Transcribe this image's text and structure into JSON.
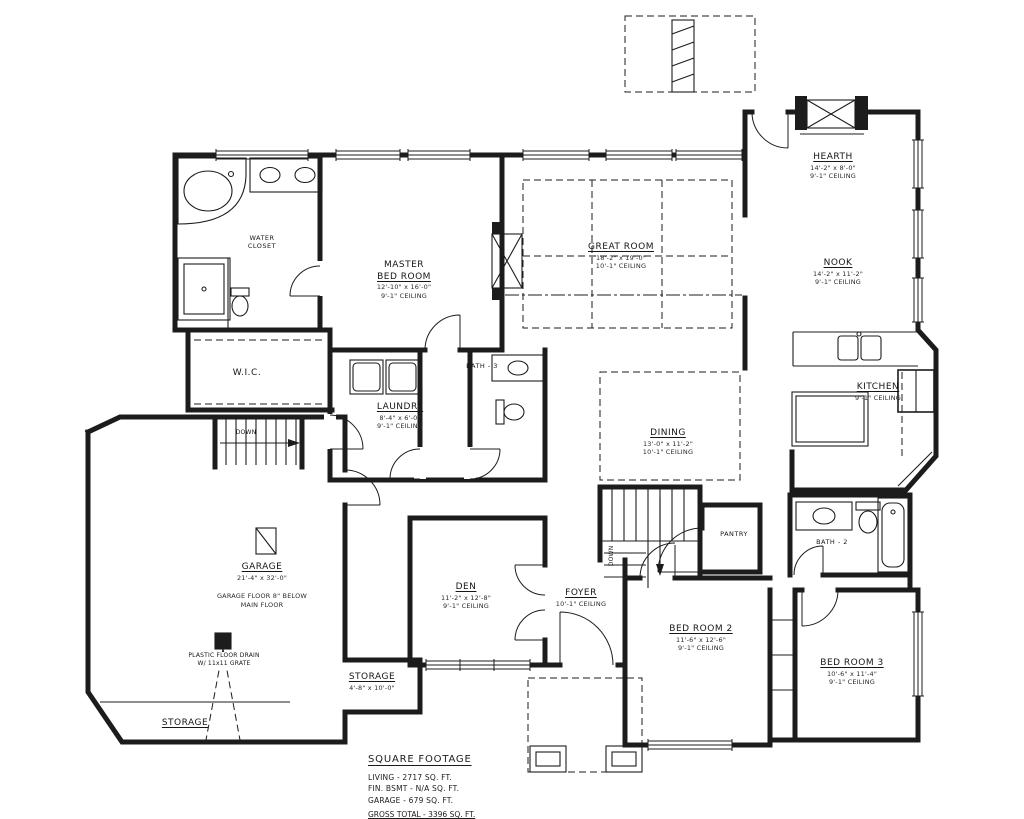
{
  "colors": {
    "line": "#1c1c1c",
    "background": "#ffffff"
  },
  "rooms": {
    "master": {
      "name_top": "MASTER",
      "name": "BED ROOM",
      "dims": "12'-10\" x 16'-0\"",
      "ceiling": "9'-1\" CEILING"
    },
    "great": {
      "name": "GREAT ROOM",
      "dims": "18'-2\" x 19'-0\"",
      "ceiling": "10'-1\" CEILING"
    },
    "hearth": {
      "name": "HEARTH",
      "dims": "14'-2\" x 8'-0\"",
      "ceiling": "9'-1\" CEILING"
    },
    "nook": {
      "name": "NOOK",
      "dims": "14'-2\" x 11'-2\"",
      "ceiling": "9'-1\" CEILING"
    },
    "kitchen": {
      "name": "KITCHEN",
      "ceiling": "9'-1\" CEILING"
    },
    "dining": {
      "name": "DINING",
      "dims": "13'-0\" x 11'-2\"",
      "ceiling": "10'-1\" CEILING"
    },
    "laundry": {
      "name": "LAUNDRY",
      "dims": "8'-4\" x 6'-0\"",
      "ceiling": "9'-1\" CEILING"
    },
    "wic": {
      "name": "W.I.C."
    },
    "garage": {
      "name": "GARAGE",
      "dims": "21'-4\" x 32'-0\"",
      "note1": "GARAGE FLOOR 8\" BELOW",
      "note2": "MAIN FLOOR"
    },
    "den": {
      "name": "DEN",
      "dims": "11'-2\" x 12'-8\"",
      "ceiling": "9'-1\" CEILING"
    },
    "foyer": {
      "name": "FOYER",
      "ceiling": "10'-1\" CEILING"
    },
    "bed2": {
      "name": "BED ROOM 2",
      "dims": "11'-6\" x 12'-6\"",
      "ceiling": "9'-1\" CEILING"
    },
    "bed3": {
      "name": "BED ROOM 3",
      "dims": "10'-6\" x 11'-4\"",
      "ceiling": "9'-1\" CEILING"
    },
    "storage_main": {
      "name": "STORAGE",
      "dims": "4'-8\" x 10'-0\""
    },
    "storage_garage": {
      "name": "STORAGE"
    },
    "pantry": {
      "name": "PANTRY"
    },
    "bath2": {
      "name": "BATH - 2"
    },
    "bath3": {
      "name": "BATH - 3"
    },
    "water_closet": {
      "name": "WATER",
      "name2": "CLOSET"
    }
  },
  "annotations": {
    "down": "DOWN",
    "floor_drain_1": "PLASTIC FLOOR DRAIN",
    "floor_drain_2": "W/ 11x11 GRATE"
  },
  "square_footage": {
    "title": "SQUARE FOOTAGE",
    "lines": [
      "LIVING - 2717 SQ. FT.",
      "FIN. BSMT - N/A SQ. FT.",
      "GARAGE - 679 SQ. FT."
    ],
    "total": "GROSS TOTAL - 3396 SQ. FT."
  }
}
